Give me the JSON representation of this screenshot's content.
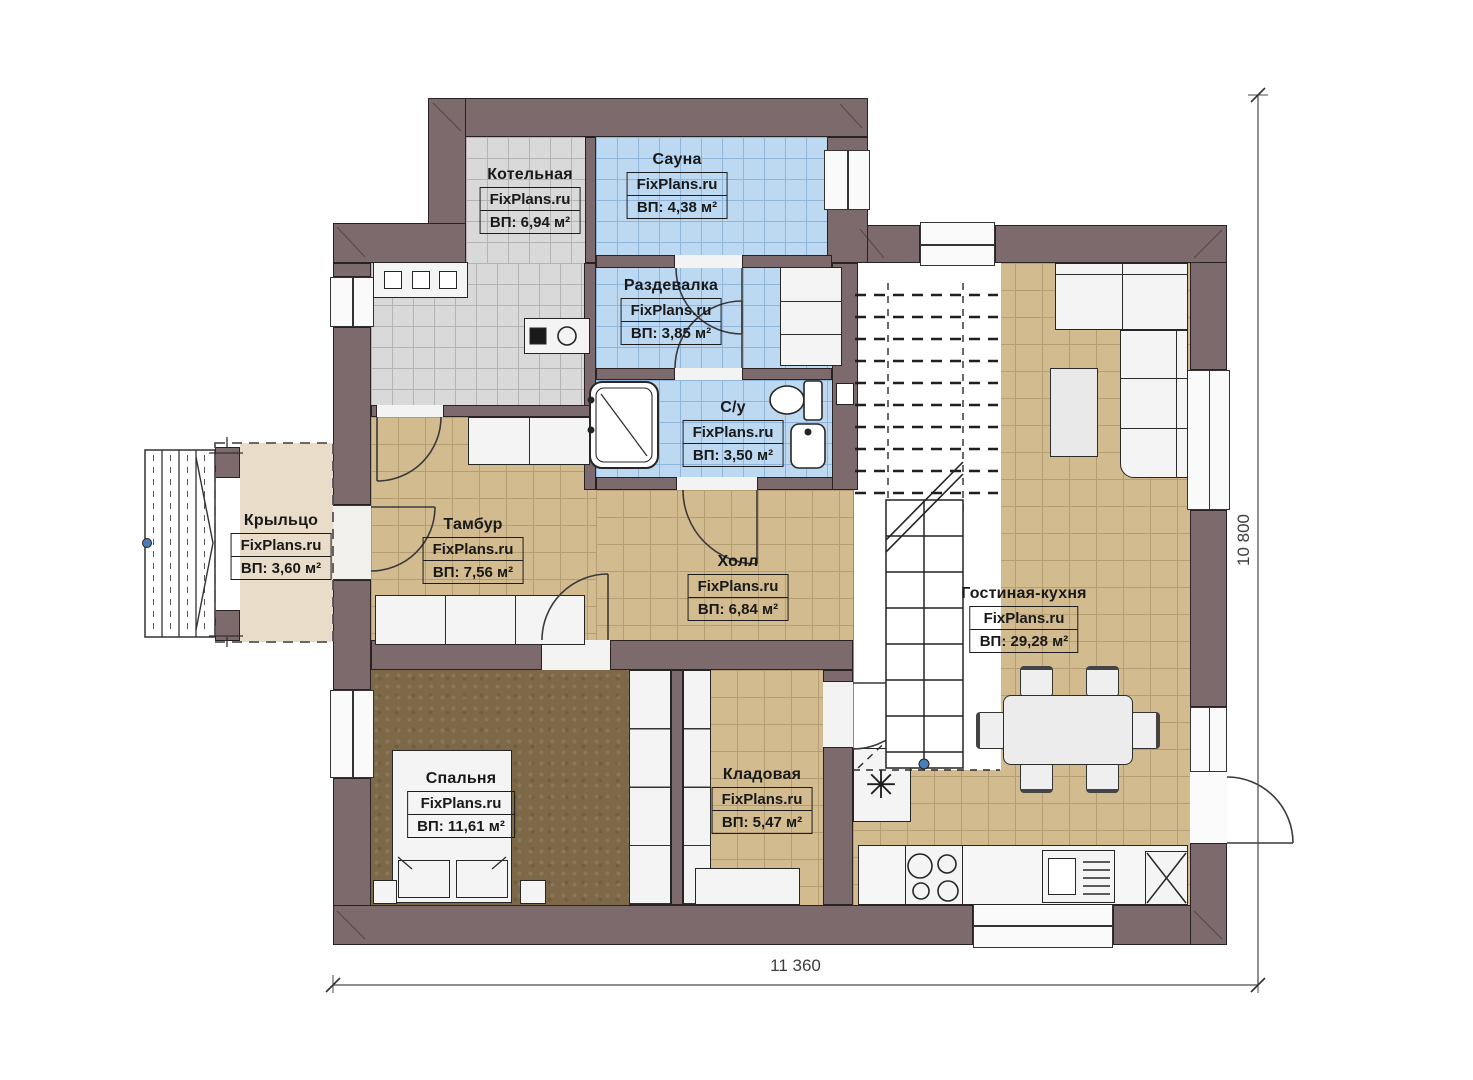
{
  "brand": {
    "label": "FixPlans.ru"
  },
  "rooms": [
    {
      "id": "kotelnaya",
      "name": "Котельная",
      "area": "ВП: 6,94 м²"
    },
    {
      "id": "sauna",
      "name": "Сауна",
      "area": "ВП: 4,38 м²"
    },
    {
      "id": "razdevalka",
      "name": "Раздевалка",
      "area": "ВП: 3,85 м²"
    },
    {
      "id": "su",
      "name": "С/у",
      "area": "ВП: 3,50 м²"
    },
    {
      "id": "kryltso",
      "name": "Крыльцо",
      "area": "ВП: 3,60 м²"
    },
    {
      "id": "tambur",
      "name": "Тамбур",
      "area": "ВП: 7,56 м²"
    },
    {
      "id": "holl",
      "name": "Холл",
      "area": "ВП: 6,84 м²"
    },
    {
      "id": "gostinaya",
      "name": "Гостиная-кухня",
      "area": "ВП: 29,28 м²"
    },
    {
      "id": "spalnya",
      "name": "Спальня",
      "area": "ВП: 11,61 м²"
    },
    {
      "id": "kladovaya",
      "name": "Кладовая",
      "area": "ВП: 5,47 м²"
    }
  ],
  "dimensions": {
    "width": "11 360",
    "height": "10 800"
  },
  "symbols": {
    "boiler_unit": "✳"
  },
  "colors": {
    "wall": "#7d6a6c",
    "tile_beige": "#d3bb90",
    "tile_gray": "#d9d9d9",
    "tile_blue": "#bdd9f2",
    "floor_bedroom": "#7d6947",
    "floor_porch": "#e9dcc8",
    "stair_node_dot": "#4a7fb5"
  }
}
